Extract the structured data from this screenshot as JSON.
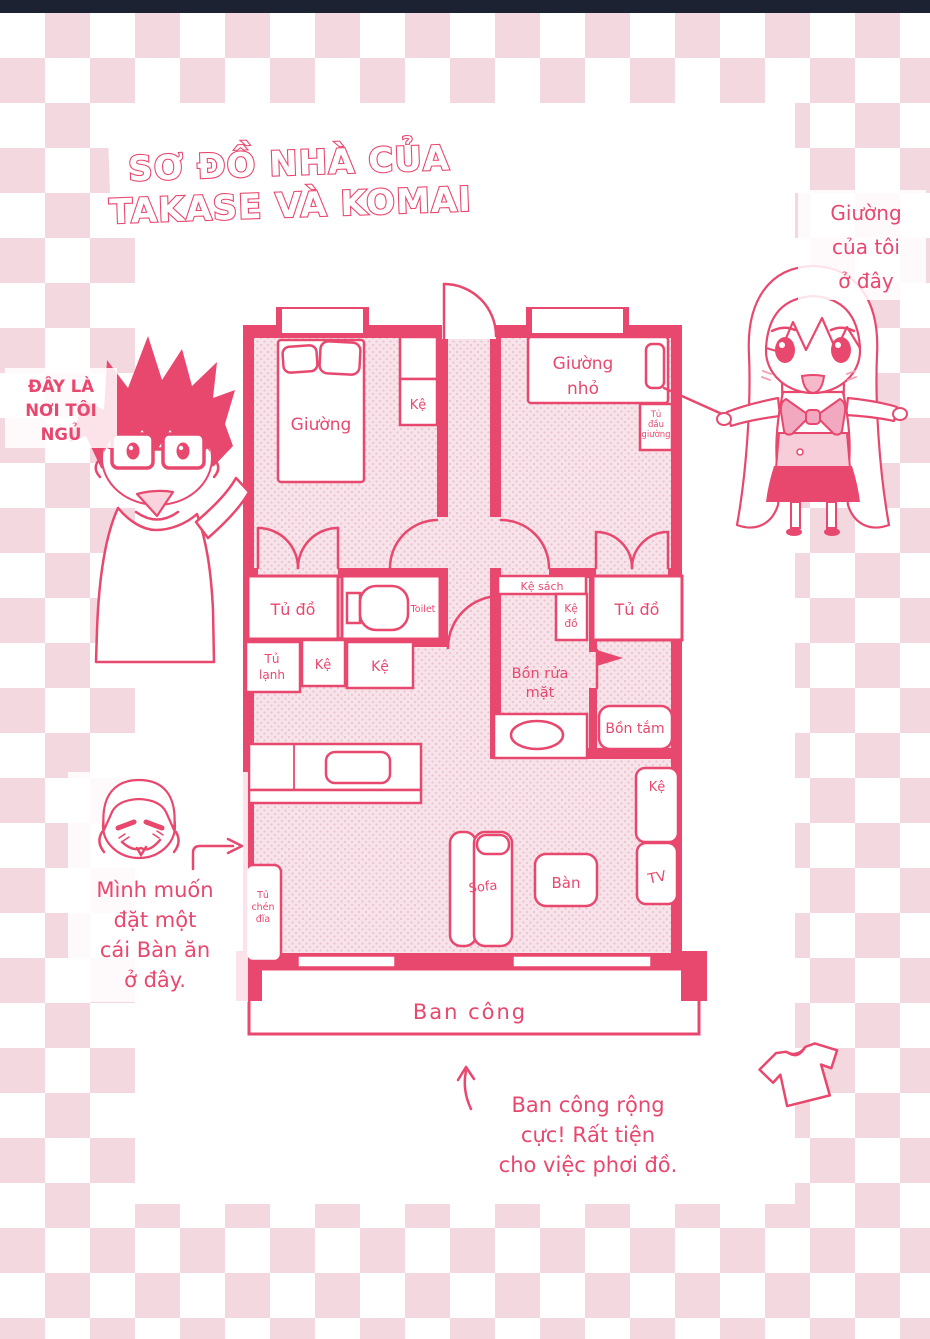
{
  "page": {
    "title": [
      "SƠ ĐỒ NHÀ CỦA",
      "TAKASE VÀ KOMAI"
    ]
  },
  "notes": {
    "boy": [
      "ĐÂY LÀ",
      "NƠI TÔI",
      "NGỦ"
    ],
    "girl": [
      "Giường",
      "của tôi",
      "ở đây"
    ],
    "dining": [
      "Mình muốn",
      "đặt một",
      "cái Bàn ăn",
      "ở đây."
    ],
    "balcony": [
      "Ban công rộng",
      "cực! Rất tiện",
      "cho việc phơi đồ."
    ]
  },
  "plan": {
    "bed_main": "Giường",
    "bedroom_shelf": "Kệ",
    "bed_small": [
      "Giường",
      "nhỏ"
    ],
    "nightstand": [
      "Tủ",
      "đầu",
      "giường"
    ],
    "closet_left": "Tủ đồ",
    "closet_right": "Tủ đồ",
    "toilet": "Toilet",
    "fridge": [
      "Tủ",
      "lạnh"
    ],
    "kitchen_shelf_small": "Kệ",
    "kitchen_shelf_large": "Kệ",
    "bookshelf": "Kệ sách",
    "bath_shelf": [
      "Kệ",
      "đồ"
    ],
    "washbasin": [
      "Bồn rửa",
      "mặt"
    ],
    "bathtub": "Bồn tắm",
    "living_shelf": "Kệ",
    "tv": "TV",
    "table": "Bàn",
    "sofa": "Sofa",
    "dish_cabinet": [
      "Tủ",
      "chén",
      "đĩa"
    ],
    "balcony": "Ban công"
  },
  "colors": {
    "ink": "#e8486e",
    "checker": "#f3d8e0",
    "top_bar": "#1c2231",
    "floor_bg": "#f7e3e9",
    "floor_dot": "#e9c4cf"
  }
}
